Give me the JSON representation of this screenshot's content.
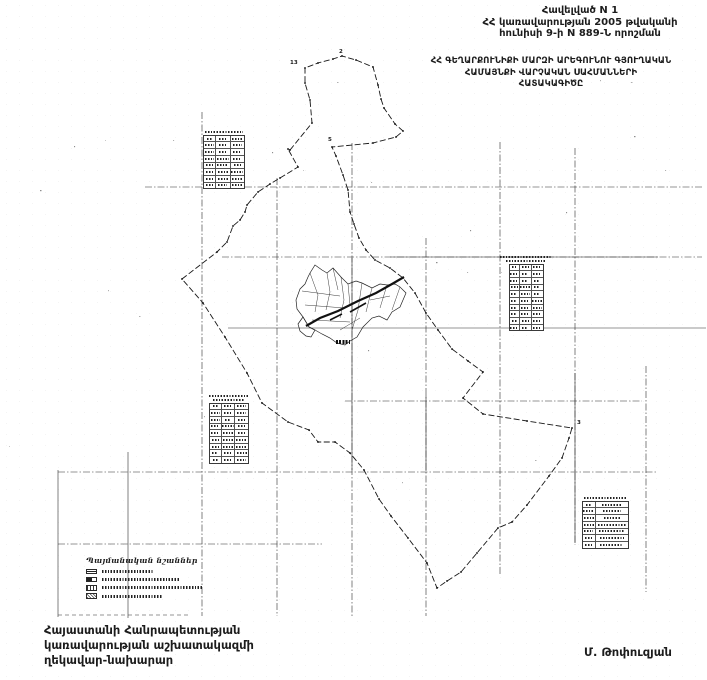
{
  "colors": {
    "background": "#ffffff",
    "ink": "#1c1c1c"
  },
  "header": {
    "line1": "Հավելված N 1",
    "line2": "ՀՀ կառավարության 2005 թվականի",
    "line3": "հունիսի 9-ի N 889-Ն որոշման"
  },
  "map_title": {
    "line1": "ՀՀ ԳԵՂԱՐՔՈՒՆԻՔԻ ՄԱՐԶԻ ԱՐԵԳՈՒՆՈՒ ԳՅՈՒՂԱԿԱՆ",
    "line2": "ՀԱՄԱՅՆՔԻ ՎԱՐՉԱԿԱՆ ՍԱՀՄԱՆՆԵՐԻ",
    "line3": "ՀԱՏԱԿԱԳԻԾԸ"
  },
  "legend": {
    "title": "Պայմանական նշաններ",
    "labels_legible": false,
    "items": [
      {
        "symbol": "boundary-line-symbol",
        "label_width": 52
      },
      {
        "symbol": "settlement-area-symbol",
        "label_width": 78
      },
      {
        "symbol": "numbered-parcel-symbol",
        "label_width": 100
      },
      {
        "symbol": "dotted-area-symbol",
        "label_width": 60
      }
    ]
  },
  "tables": [
    {
      "name": "data-table-upper-left",
      "legible": false,
      "title_lines": 1,
      "rows": 8,
      "cols": 3
    },
    {
      "name": "data-table-right-middle",
      "legible": false,
      "title_lines": 2,
      "rows": 10,
      "cols": 3
    },
    {
      "name": "data-table-left-middle",
      "legible": false,
      "title_lines": 2,
      "rows": 9,
      "cols": 3
    },
    {
      "name": "data-table-lower-right",
      "legible": false,
      "title_lines": 1,
      "rows": 7,
      "cols": 2
    }
  ],
  "vertex_labels": [
    {
      "text": "13",
      "x": 290,
      "y": 61
    },
    {
      "text": "2",
      "x": 339,
      "y": 50
    },
    {
      "text": "5",
      "x": 328,
      "y": 138
    },
    {
      "text": "3",
      "x": 577,
      "y": 421
    }
  ],
  "footer": {
    "left_line1": "Հայաստանի Հանրապետության",
    "left_line2": "կառավարության աշխատակազմի",
    "left_line3": "ղեկավար-նախարար",
    "signature": "Մ. Թոփուզյան"
  }
}
